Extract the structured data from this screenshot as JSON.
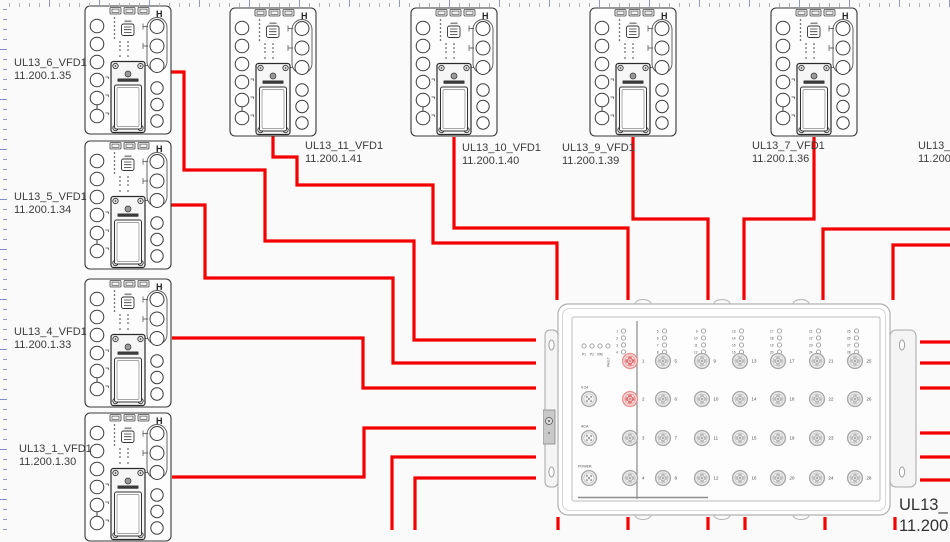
{
  "colors": {
    "wire": "#f40000",
    "port_highlight_ring": "#e89090",
    "port_highlight_fill": "#fbe4e4",
    "port_highlight_pad": "#e07878",
    "port_ring": "#a8a8a8",
    "port_fill": "#f2f2f2",
    "port_pad": "#bdbdbd"
  },
  "devices": [
    {
      "id": "ul13-6",
      "label": "UL13_6_VFD1",
      "ip": "11.200.1.35",
      "dev": {
        "x": 84,
        "y": 5
      },
      "lab": {
        "x": 14,
        "y": 57
      }
    },
    {
      "id": "ul13-5",
      "label": "UL13_5_VFD1",
      "ip": "11.200.1.34",
      "dev": {
        "x": 84,
        "y": 140
      },
      "lab": {
        "x": 14,
        "y": 191
      }
    },
    {
      "id": "ul13-4",
      "label": "UL13_4_VFD1",
      "ip": "11.200.1.33",
      "dev": {
        "x": 84,
        "y": 278
      },
      "lab": {
        "x": 14,
        "y": 326
      }
    },
    {
      "id": "ul13-1",
      "label": "UL13_1_VFD1",
      "ip": "11.200.1.30",
      "dev": {
        "x": 84,
        "y": 412
      },
      "lab": {
        "x": 19,
        "y": 443
      }
    },
    {
      "id": "ul13-11",
      "label": "UL13_11_VFD1",
      "ip": "11.200.1.41",
      "dev": {
        "x": 229,
        "y": 7
      },
      "lab": {
        "x": 305,
        "y": 140
      }
    },
    {
      "id": "ul13-10",
      "label": "UL13_10_VFD1",
      "ip": "11.200.1.40",
      "dev": {
        "x": 410,
        "y": 7
      },
      "lab": {
        "x": 462,
        "y": 142
      }
    },
    {
      "id": "ul13-9",
      "label": "UL13_9_VFD1",
      "ip": "11.200.1.39",
      "dev": {
        "x": 589,
        "y": 7
      },
      "lab": {
        "x": 562,
        "y": 142
      }
    },
    {
      "id": "ul13-7",
      "label": "UL13_7_VFD1",
      "ip": "11.200.1.36",
      "dev": {
        "x": 770,
        "y": 7
      },
      "lab": {
        "x": 752,
        "y": 140
      }
    },
    {
      "id": "ul13-8",
      "label": "UL13_8_VFD1",
      "ip": "11.200.1.37",
      "dev": null,
      "lab": {
        "x": 918,
        "y": 140
      }
    }
  ],
  "switch": {
    "label": "UL13_",
    "label2": "11.200",
    "status_leds": [
      "P1",
      "P2",
      "RM",
      "FAULT"
    ],
    "aux_ports": [
      "V.24",
      "ACA",
      "POWER"
    ],
    "left_ports": [
      1,
      2,
      3,
      4
    ],
    "highlighted_ports": [
      1,
      2
    ],
    "port_columns": [
      [
        5,
        6,
        7,
        8
      ],
      [
        9,
        10,
        11,
        12
      ],
      [
        13,
        14,
        15,
        16
      ],
      [
        17,
        18,
        19,
        20
      ],
      [
        21,
        22,
        23,
        24
      ],
      [
        25,
        26,
        27,
        28
      ]
    ]
  },
  "wires": [
    {
      "id": "ul13-6-to-switch",
      "points": "170,72 184,72 184,170 265,170 265,241 414,241 414,340 536,340"
    },
    {
      "id": "ul13-5-to-switch",
      "points": "171,205 205,205 205,278 393,278 393,363 536,363"
    },
    {
      "id": "ul13-4-to-switch",
      "points": "172,338 363,338 363,388 536,388"
    },
    {
      "id": "ul13-1-to-switch",
      "points": "172,477 364,477 364,428 536,428"
    },
    {
      "id": "bottom-left-wire-a",
      "points": "392,530 392,457 536,457"
    },
    {
      "id": "bottom-left-wire-b",
      "points": "415,530 415,478 536,478"
    },
    {
      "id": "ul13-11-to-switch",
      "points": "273,136 273,157 297,157 297,185 433,185 433,243 557,243 557,300"
    },
    {
      "id": "ul13-10-to-switch",
      "points": "454,137 454,228 628,228 628,300"
    },
    {
      "id": "ul13-9-to-switch",
      "points": "633,137 633,219 708,219 708,300"
    },
    {
      "id": "ul13-7-to-switch",
      "points": "814,137 814,219 744,219 744,300"
    },
    {
      "id": "right-edge-wire-a",
      "points": "950,229 823,229 823,300"
    },
    {
      "id": "right-edge-wire-b",
      "points": "950,245 893,245 893,300"
    },
    {
      "id": "stub-bottom-1",
      "points": "558,517 558,530"
    },
    {
      "id": "stub-bottom-2",
      "points": "628,517 628,530"
    },
    {
      "id": "stub-bottom-3",
      "points": "708,517 708,530"
    },
    {
      "id": "stub-bottom-4",
      "points": "745,517 745,530"
    },
    {
      "id": "stub-bottom-5",
      "points": "825,517 825,530"
    },
    {
      "id": "stub-bottom-6",
      "points": "895,517 895,530"
    },
    {
      "id": "stub-right-1",
      "points": "920,342 950,342"
    },
    {
      "id": "stub-right-2",
      "points": "920,363 950,363"
    },
    {
      "id": "stub-right-3",
      "points": "920,388 950,388"
    },
    {
      "id": "stub-right-4",
      "points": "920,433 950,433"
    },
    {
      "id": "stub-right-5",
      "points": "920,457 950,457"
    },
    {
      "id": "stub-right-6",
      "points": "920,480 950,480"
    }
  ]
}
